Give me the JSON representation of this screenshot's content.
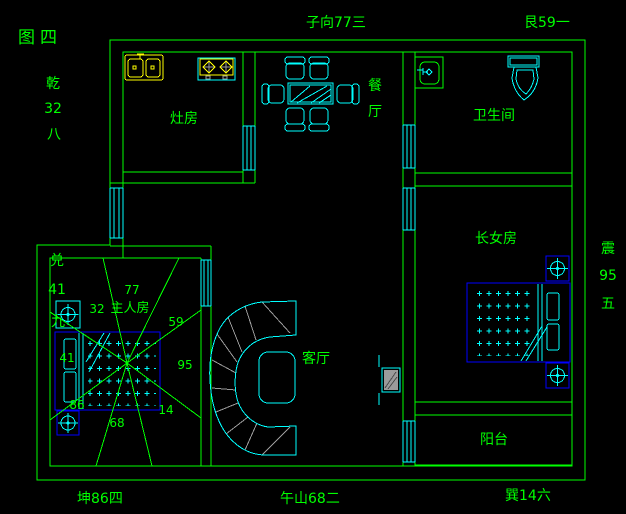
{
  "figure_title": "图四",
  "colors": {
    "background": "#000000",
    "wall_line": "#00ff00",
    "furniture": "#00ffff",
    "fixture": "#ffff00",
    "bed_outline": "#0000ff",
    "detail_gray": "#9b9b9b"
  },
  "compass_labels": {
    "top_center": "子向77三",
    "top_right": "艮59一",
    "left_upper": {
      "chars": [
        "乾",
        "32",
        "八"
      ]
    },
    "left_lower": {
      "chars": [
        "兑",
        "41",
        "九"
      ]
    },
    "right_side": {
      "chars": [
        "震",
        "95",
        "五"
      ]
    },
    "bottom_left": "坤86四",
    "bottom_center": "午山68二",
    "bottom_right": "巽14六"
  },
  "rooms": {
    "kitchen": {
      "label": "灶房"
    },
    "dining": {
      "chars": [
        "餐",
        "厅"
      ]
    },
    "bathroom": {
      "label": "卫生间"
    },
    "eldest_daughter": {
      "label": "长女房"
    },
    "master": {
      "label": "主人房"
    },
    "living": {
      "label": "客厅"
    },
    "balcony": {
      "label": "阳台"
    }
  },
  "master_star_chart": {
    "top": "77",
    "top_right": "59",
    "right": "95",
    "bottom_right": "14",
    "bottom": "68",
    "bottom_left": "86",
    "left": "41",
    "top_left": "32"
  }
}
